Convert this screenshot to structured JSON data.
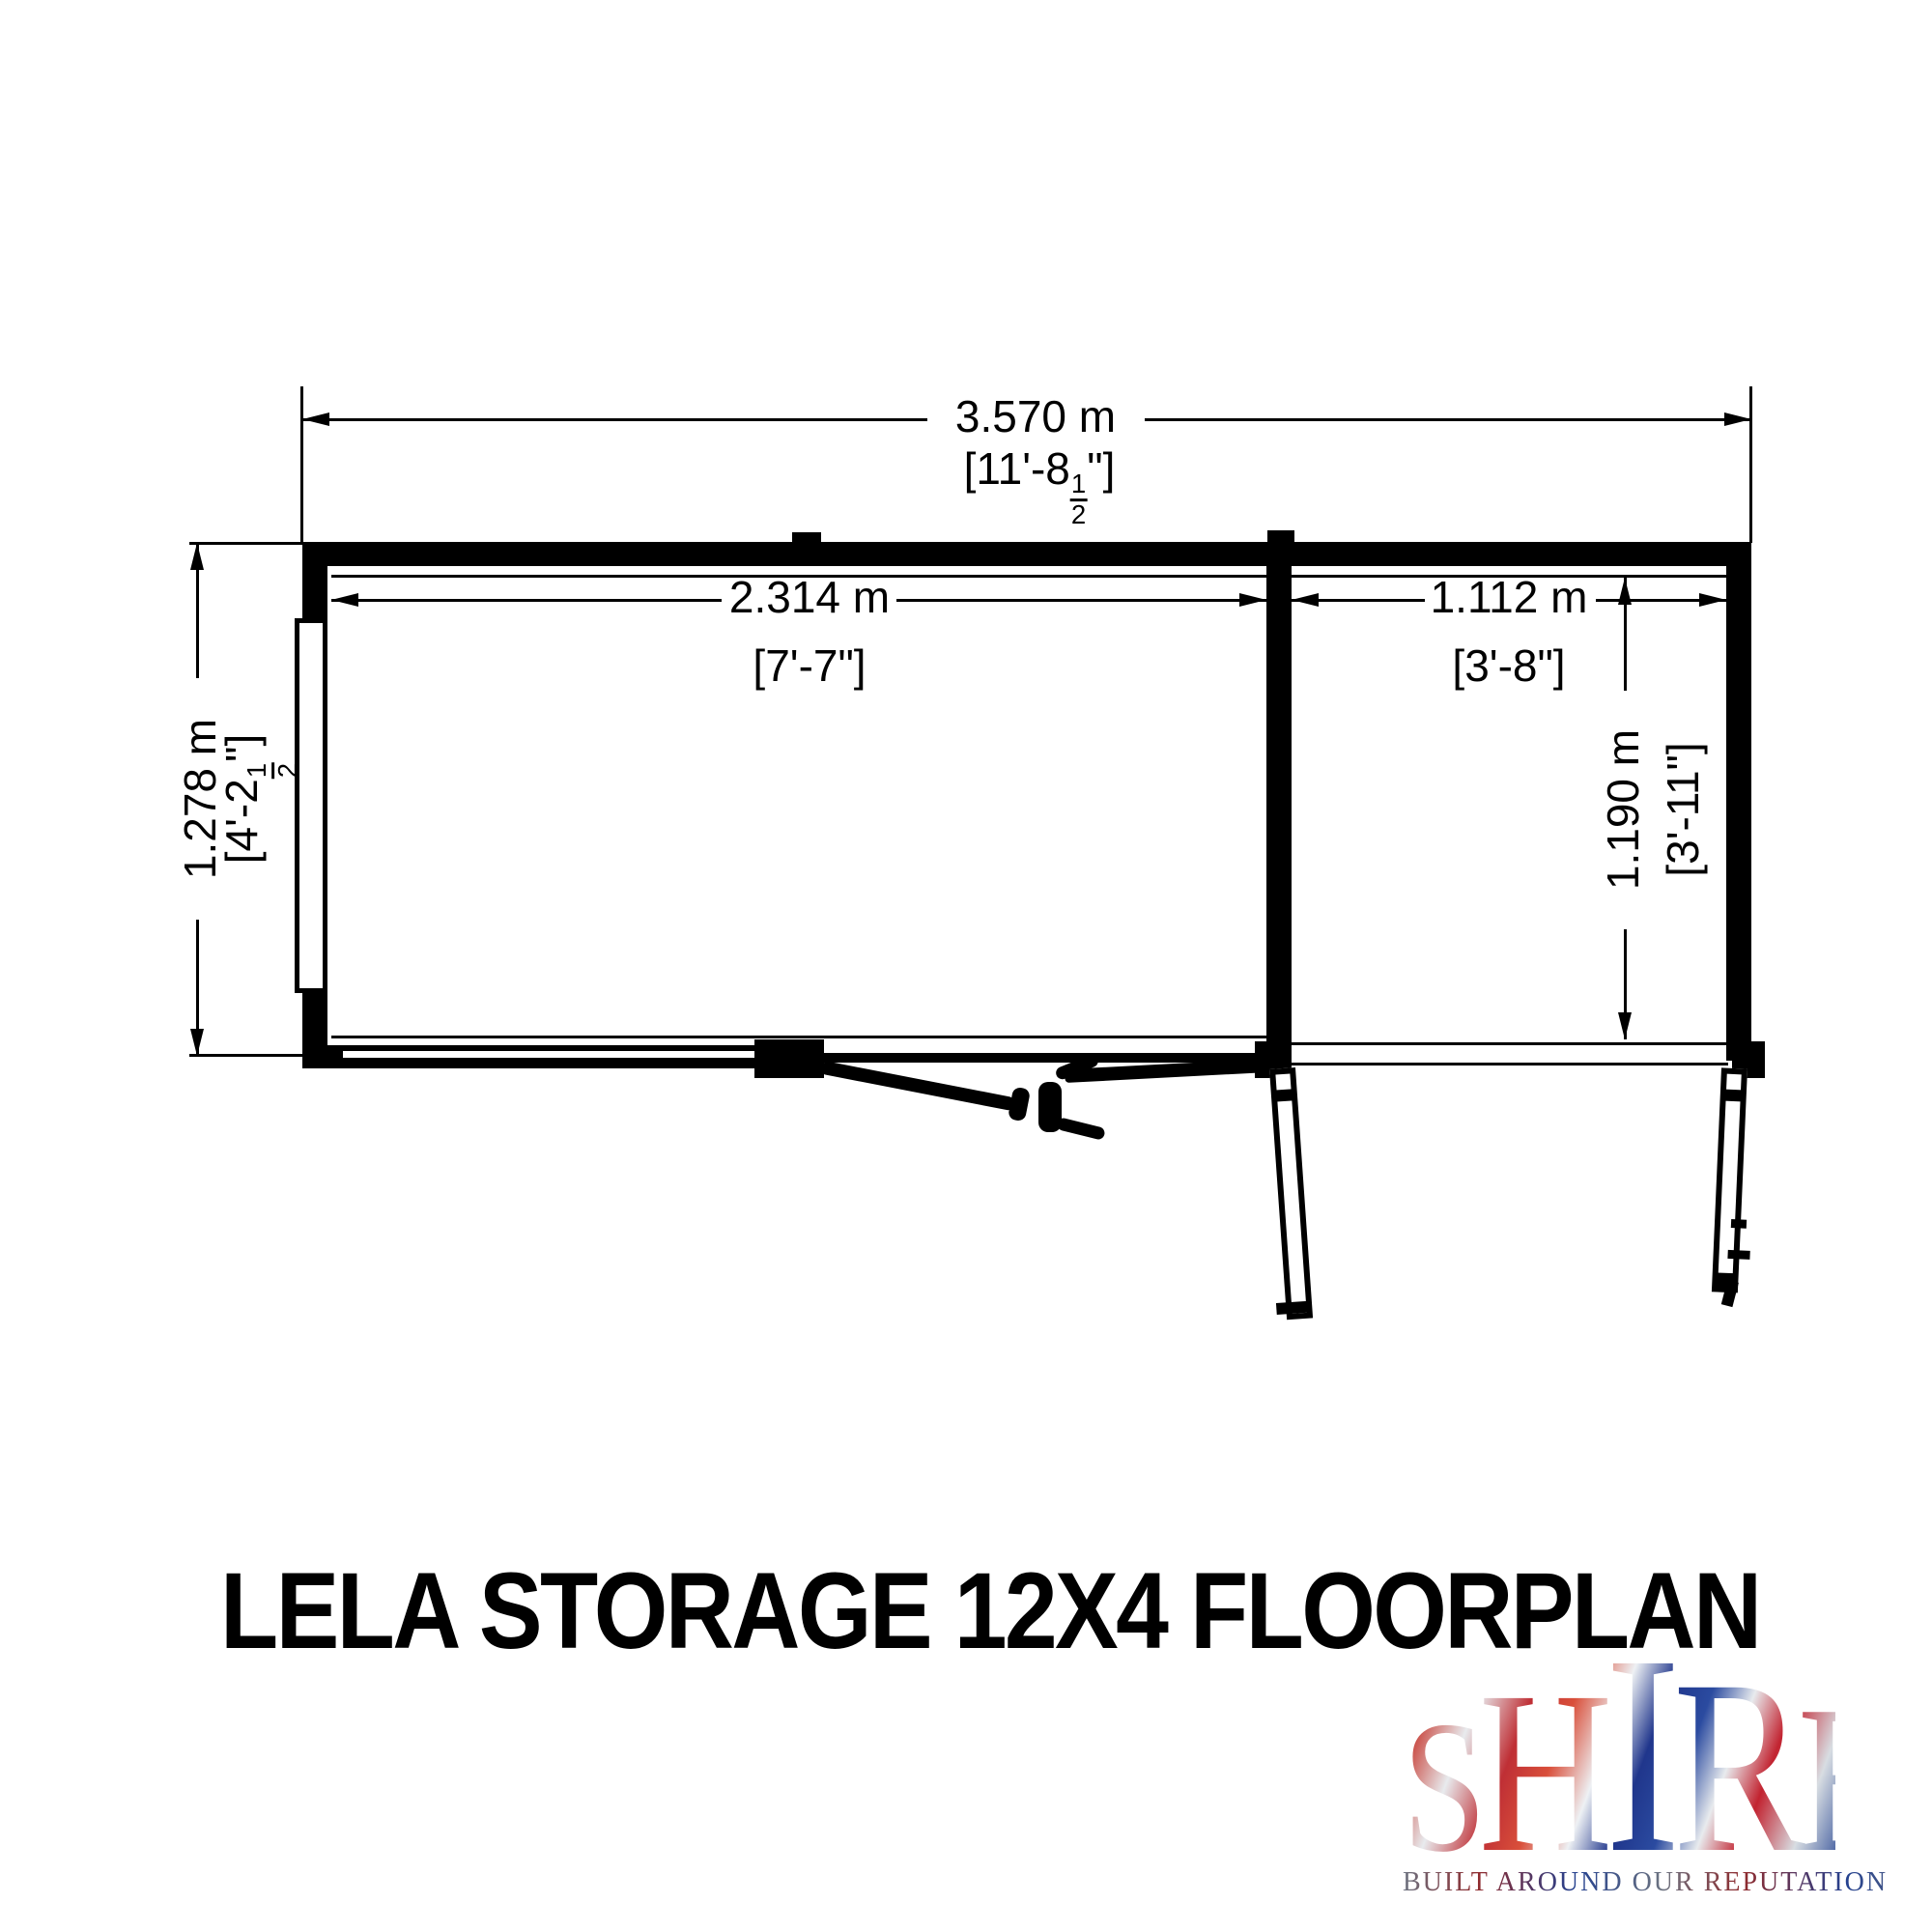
{
  "colors": {
    "ink": "#000000",
    "paper": "#ffffff",
    "flag_red": "#c8202e",
    "flag_blue": "#1f3c8c",
    "flag_silver": "#d9dee4"
  },
  "title": {
    "text": "LELA STORAGE 12X4 FLOORPLAN"
  },
  "plan": {
    "overall_width": {
      "metric": "3.570 m",
      "imperial_prefix": "[11'-8",
      "fraction_numerator": "1",
      "fraction_denominator": "2",
      "imperial_suffix": "\"]"
    },
    "left_bay_width": {
      "metric": "2.314 m",
      "imperial": "[7'-7\"]"
    },
    "right_bay_width": {
      "metric": "1.112 m",
      "imperial": "[3'-8\"]"
    },
    "overall_depth": {
      "metric": "1.278 m",
      "imperial_prefix": "[4'-2",
      "fraction_numerator": "1",
      "fraction_denominator": "2",
      "imperial_suffix": "\"]"
    },
    "right_bay_depth": {
      "metric": "1.190 m",
      "imperial": "[3'-11\"]"
    }
  },
  "logo": {
    "letters": [
      "S",
      "H",
      "I",
      "R",
      "E"
    ],
    "tagline": "BUILT AROUND OUR REPUTATION"
  }
}
